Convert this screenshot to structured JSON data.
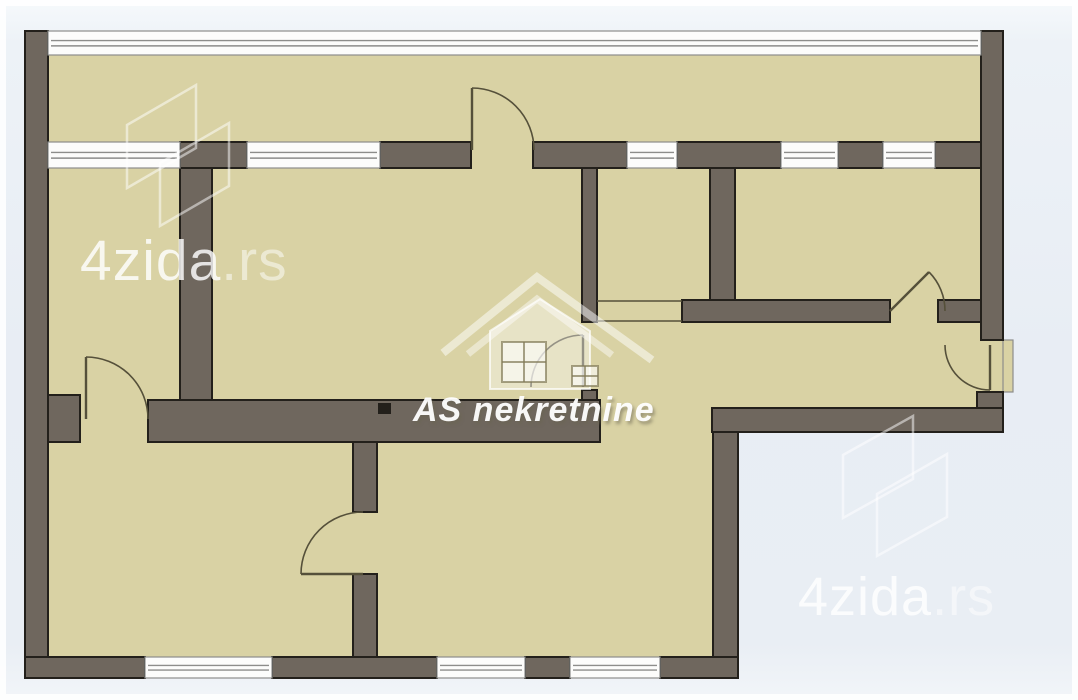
{
  "canvas": {
    "width": 1078,
    "height": 700
  },
  "colors": {
    "room_fill": "#d9d2a4",
    "wall_fill": "#6f675e",
    "wall_outline": "#23201b",
    "window_fill": "#fcfcfb",
    "window_line": "#8d8d8b",
    "door_line": "#55503a",
    "watermark_line": "rgba(255,255,255,0.5)"
  },
  "watermarks": {
    "top_left": {
      "brand": "4zida",
      "suffix": ".rs"
    },
    "bottom_right": {
      "brand": "4zida",
      "suffix": ".rs"
    },
    "center": {
      "text": "AS nekretnine"
    }
  },
  "floorplan": {
    "base": [
      {
        "name": "main-block",
        "x": 25,
        "y": 31,
        "w": 978,
        "h": 401
      },
      {
        "name": "bottom-wing",
        "x": 25,
        "y": 432,
        "w": 713,
        "h": 246
      },
      {
        "name": "entry-landing",
        "x": 1003,
        "y": 340,
        "w": 10,
        "h": 52,
        "outlined": true
      }
    ],
    "walls": [
      {
        "name": "outer-wall-west",
        "x": 25,
        "y": 31,
        "w": 23,
        "h": 647
      },
      {
        "name": "band-wall-a",
        "x": 180,
        "y": 142,
        "w": 67,
        "h": 26
      },
      {
        "name": "band-wall-b",
        "x": 380,
        "y": 142,
        "w": 91,
        "h": 26
      },
      {
        "name": "band-wall-c",
        "x": 533,
        "y": 142,
        "w": 94,
        "h": 26
      },
      {
        "name": "band-wall-d",
        "x": 677,
        "y": 142,
        "w": 104,
        "h": 26
      },
      {
        "name": "band-wall-e",
        "x": 838,
        "y": 142,
        "w": 45,
        "h": 26
      },
      {
        "name": "band-wall-f",
        "x": 935,
        "y": 142,
        "w": 46,
        "h": 26
      },
      {
        "name": "outer-wall-east",
        "x": 981,
        "y": 31,
        "w": 22,
        "h": 309
      },
      {
        "name": "east-corner-block",
        "x": 977,
        "y": 392,
        "w": 26,
        "h": 40
      },
      {
        "name": "wall-room1-east",
        "x": 180,
        "y": 168,
        "w": 32,
        "h": 245
      },
      {
        "name": "wall-kitchen-west",
        "x": 582,
        "y": 168,
        "w": 15,
        "h": 154
      },
      {
        "name": "wall-living-door-stub",
        "x": 582,
        "y": 390,
        "w": 15,
        "h": 14
      },
      {
        "name": "wall-kitchen-east",
        "x": 710,
        "y": 168,
        "w": 25,
        "h": 132
      },
      {
        "name": "wall-hall-north-a",
        "x": 682,
        "y": 300,
        "w": 208,
        "h": 22
      },
      {
        "name": "wall-hall-north-b",
        "x": 938,
        "y": 300,
        "w": 43,
        "h": 22
      },
      {
        "name": "wall-mid-stub-left",
        "x": 48,
        "y": 395,
        "w": 32,
        "h": 47
      },
      {
        "name": "wall-mid-main",
        "x": 148,
        "y": 400,
        "w": 452,
        "h": 42
      },
      {
        "name": "wall-hall-south",
        "x": 712,
        "y": 408,
        "w": 291,
        "h": 24
      },
      {
        "name": "wall-wing-east",
        "x": 713,
        "y": 432,
        "w": 25,
        "h": 246
      },
      {
        "name": "wall-south-a",
        "x": 25,
        "y": 657,
        "w": 120,
        "h": 21
      },
      {
        "name": "wall-south-b",
        "x": 272,
        "y": 657,
        "w": 165,
        "h": 21
      },
      {
        "name": "wall-south-c",
        "x": 525,
        "y": 657,
        "w": 45,
        "h": 21
      },
      {
        "name": "wall-south-d",
        "x": 660,
        "y": 657,
        "w": 78,
        "h": 21
      },
      {
        "name": "wall-wing-divider-n",
        "x": 353,
        "y": 442,
        "w": 24,
        "h": 70
      },
      {
        "name": "wall-wing-divider-s",
        "x": 353,
        "y": 574,
        "w": 24,
        "h": 83
      }
    ],
    "windows": [
      {
        "name": "balcony-glazing",
        "x": 48,
        "y": 31,
        "w": 933,
        "h": 24
      },
      {
        "name": "window-room1",
        "x": 48,
        "y": 142,
        "w": 132,
        "h": 26
      },
      {
        "name": "window-living",
        "x": 247,
        "y": 142,
        "w": 133,
        "h": 26
      },
      {
        "name": "window-kitchen",
        "x": 627,
        "y": 142,
        "w": 50,
        "h": 26
      },
      {
        "name": "window-bedroom-a",
        "x": 781,
        "y": 142,
        "w": 57,
        "h": 26
      },
      {
        "name": "window-bedroom-b",
        "x": 883,
        "y": 142,
        "w": 52,
        "h": 26
      },
      {
        "name": "window-bottom-left",
        "x": 145,
        "y": 657,
        "w": 127,
        "h": 21
      },
      {
        "name": "window-bottom-center-a",
        "x": 437,
        "y": 657,
        "w": 88,
        "h": 21
      },
      {
        "name": "window-bottom-center-b",
        "x": 570,
        "y": 657,
        "w": 90,
        "h": 21
      }
    ],
    "doors": [
      {
        "name": "balcony-door",
        "leaf": [
          472,
          88,
          472,
          150
        ],
        "arc": "M472 88 A62 62 0 0 1 534 150"
      },
      {
        "name": "room1-door",
        "leaf": [
          86,
          357,
          86,
          419
        ],
        "arc": "M86 357 A62 62 0 0 1 148 419"
      },
      {
        "name": "living-room-door",
        "leaf": [
          583,
          335,
          583,
          387
        ],
        "arc": "M583 335 A52 52 0 0 0 531 387"
      },
      {
        "name": "wing-room-door",
        "leaf": [
          301,
          574,
          363,
          574
        ],
        "arc": "M301 574 A62 62 0 0 1 363 512"
      },
      {
        "name": "bedroom-door",
        "leaf": [
          890,
          311,
          929,
          272
        ],
        "arc": "M929 272 A55 55 0 0 1 945 311"
      },
      {
        "name": "entry-door",
        "leaf": [
          990,
          345,
          990,
          390
        ],
        "arc": "M945 345 A45 45 0 0 0 990 390"
      }
    ],
    "lines": [
      {
        "name": "kitchen-passage-north",
        "x1": 597,
        "y1": 301,
        "x2": 682,
        "y2": 301
      },
      {
        "name": "kitchen-passage-south",
        "x1": 597,
        "y1": 321,
        "x2": 682,
        "y2": 321
      }
    ],
    "dot": {
      "name": "wall-dot",
      "x": 378,
      "y": 403,
      "w": 13,
      "h": 11
    },
    "logos": [
      {
        "name": "logo-4zida-top-left",
        "polys": [
          "127,125 196,85 196,148 127,188",
          "160,163 229,123 229,186 160,226"
        ]
      },
      {
        "name": "logo-4zida-bottom-right",
        "polys": [
          "843,455 913,416 913,479 843,518",
          "877,494 947,454 947,517 877,556"
        ]
      }
    ],
    "house_logo": [
      {
        "type": "polyline",
        "points": "443,353 537,277 652,360",
        "stroke": "rgba(255,255,255,0.5)",
        "width": 8
      },
      {
        "type": "polyline",
        "points": "468,354 537,299 612,355",
        "stroke": "rgba(255,255,255,0.45)",
        "width": 7
      },
      {
        "type": "polygon",
        "points": "490,331 540,299 590,331 590,389 490,389",
        "stroke": "rgba(255,255,255,0.7)",
        "width": 2,
        "fill": "rgba(255,255,255,0.38)"
      },
      {
        "type": "rect",
        "x": 502,
        "y": 342,
        "w": 44,
        "h": 40,
        "stroke": "rgba(130,123,88,0.7)",
        "width": 2,
        "fill": "rgba(255,255,255,0.6)",
        "cross": true
      },
      {
        "type": "rect",
        "x": 572,
        "y": 366,
        "w": 26,
        "h": 20,
        "stroke": "rgba(130,123,88,0.7)",
        "width": 2,
        "fill": "rgba(255,255,255,0.6)",
        "cross": true
      }
    ]
  }
}
